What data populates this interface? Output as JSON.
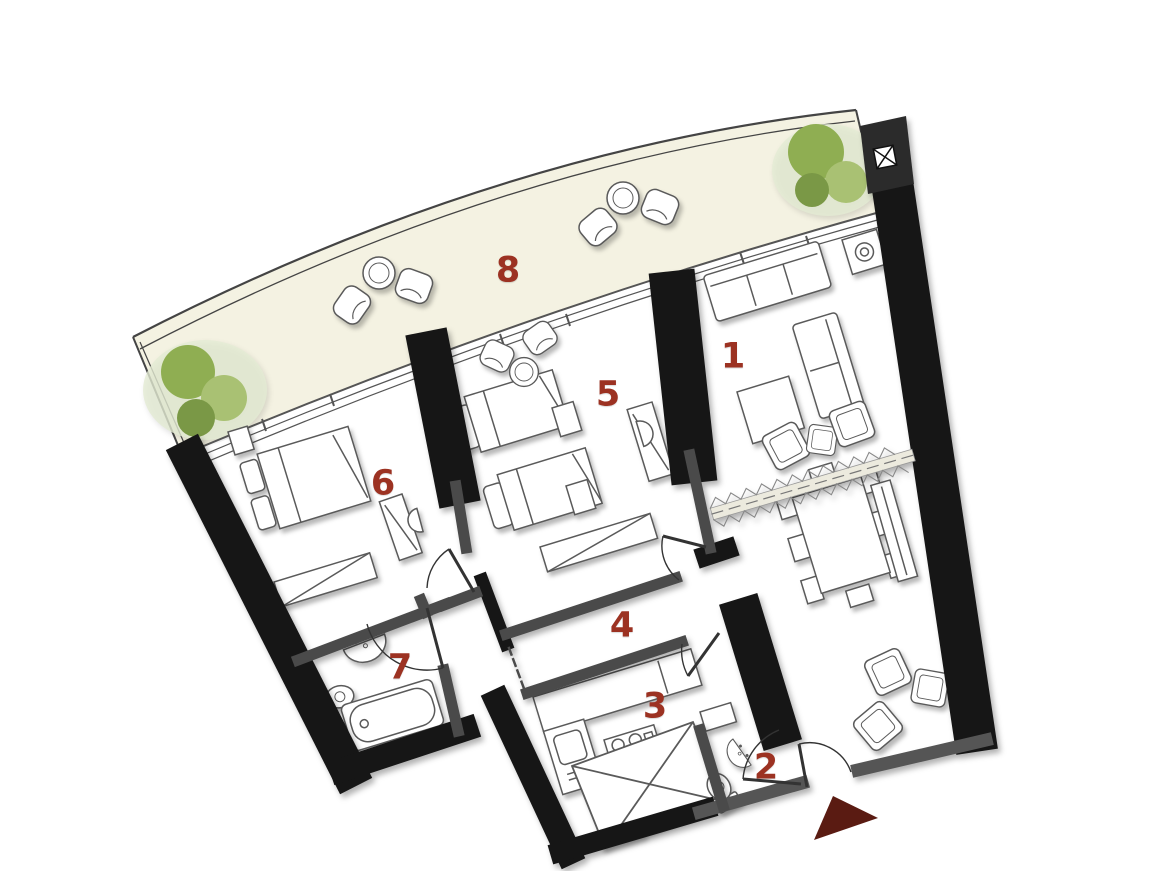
{
  "plan_title": "apartment-floor-plan",
  "colors": {
    "background": "#ffffff",
    "wall": "#161616",
    "wall_gray": "#4a4a4a",
    "wall_light": "#555555",
    "line": "#444444",
    "room_number": "#9c3222",
    "terrace_fill": "#f4f2e2",
    "tree_halo": "#e3ebd3",
    "tree_dark": "#7a9846",
    "tree_mid": "#8fae52",
    "tree_light": "#a9c173",
    "entrance_arrow": "#5a1b12",
    "furniture_stroke": "#5a5a5a"
  },
  "rooms": {
    "living": {
      "label": "1"
    },
    "wc": {
      "label": "2"
    },
    "kitchen": {
      "label": "3"
    },
    "hallway": {
      "label": "4"
    },
    "bedroom2": {
      "label": "5"
    },
    "bedroom1": {
      "label": "6"
    },
    "bathroom": {
      "label": "7"
    },
    "terrace": {
      "label": "8"
    }
  },
  "icons": {
    "entrance-arrow": "filled-triangle",
    "tree": "green-circle-cluster",
    "bed": "rect-with-pillow",
    "bathtub": "rounded-rect",
    "toilet": "ellipse-with-tank",
    "sink": "half-ellipse",
    "stove": "four-burner-circles",
    "shaft": "x-crossed-box",
    "corner-marker": "x-square",
    "sofa": "sectioned-rect",
    "dining-table": "rect-with-chairs",
    "partition": "zigzag-band",
    "door": "quarter-arc"
  }
}
